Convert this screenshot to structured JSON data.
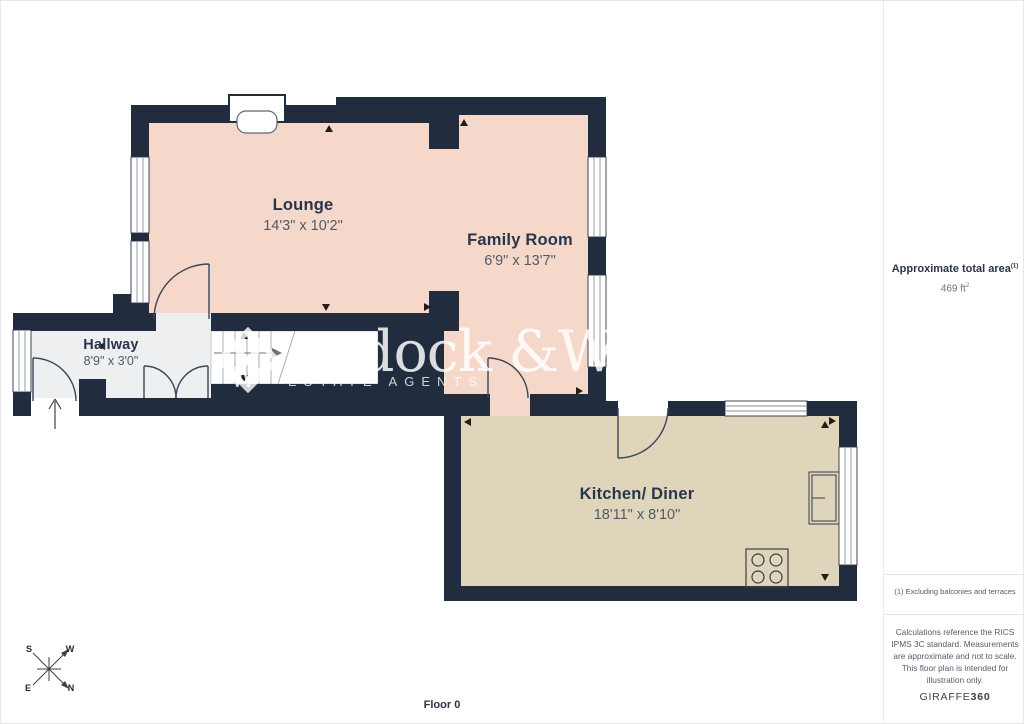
{
  "page": {
    "background": "#ffffff",
    "border_color": "#e7e7e7"
  },
  "floorplan": {
    "wall_color": "#212c3e",
    "floor_label": "Floor 0",
    "rooms": [
      {
        "name": "Lounge",
        "dimensions": "14'3\" x 10'2\"",
        "fill": "#f5d8c9"
      },
      {
        "name": "Family Room",
        "dimensions": "6'9\" x 13'7\"",
        "fill": "#f5d8c9"
      },
      {
        "name": "Hallway",
        "dimensions": "8'9\" x 3'0\"",
        "fill": "#edeff1"
      },
      {
        "name": "Kitchen/ Diner",
        "dimensions": "18'11\" x 8'10\"",
        "fill": "#ded5bb"
      }
    ],
    "compass": {
      "top_left": "S",
      "top_right": "W",
      "bottom_left": "E",
      "bottom_right": "N"
    }
  },
  "watermark": {
    "name_fragment": "dock &Was",
    "monogram": "W",
    "tagline": "ESTATE AGENTS"
  },
  "sidebar": {
    "area_title": "Approximate total area",
    "area_title_sup": "(1)",
    "area_value": "469 ft",
    "area_value_sup": "2",
    "footnote": "(1) Excluding balconies and terraces",
    "disclaimer": "Calculations reference the RICS IPMS 3C standard. Measurements are approximate and not to scale. This floor plan is intended for illustration only.",
    "brand_name": "GIRAFFE",
    "brand_suffix": "360"
  }
}
